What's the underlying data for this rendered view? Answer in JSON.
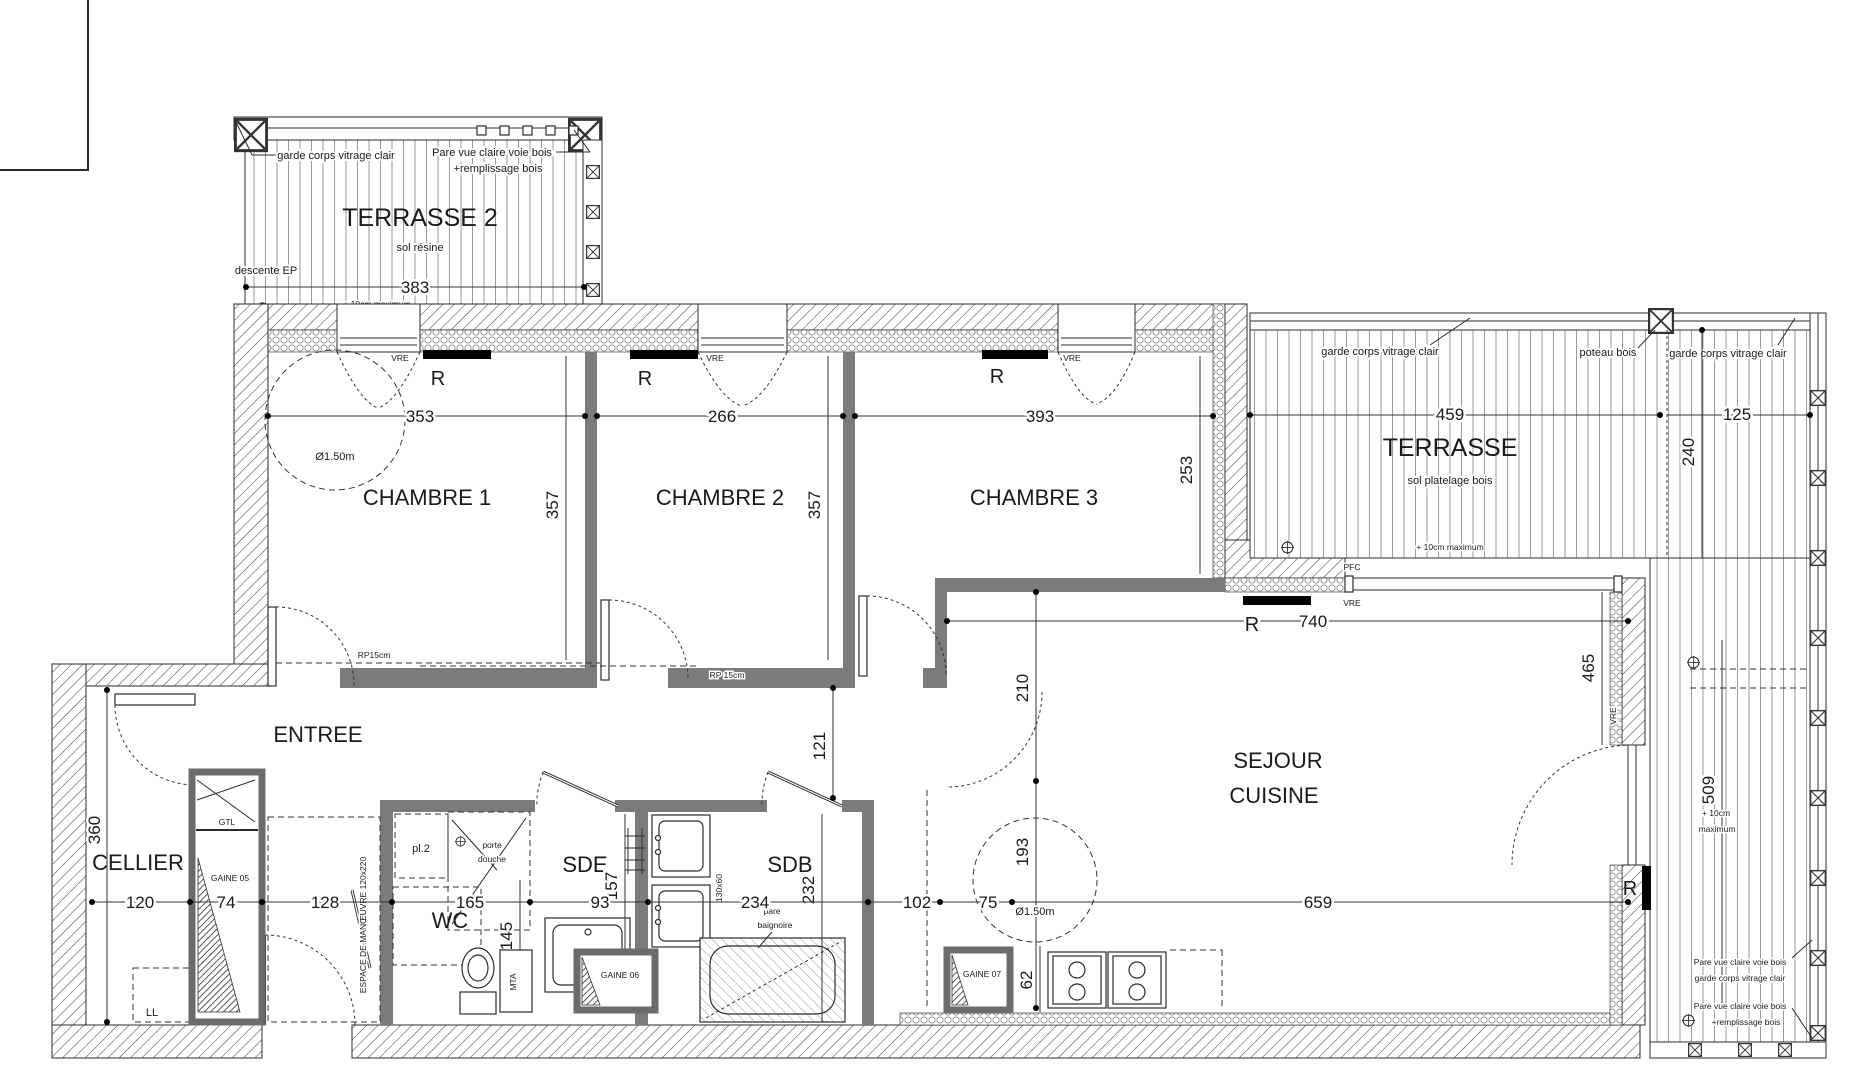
{
  "rooms": {
    "terrasse2": {
      "name": "TERRASSE 2",
      "floor": "sol résine",
      "width": "383"
    },
    "chambre1": {
      "name": "CHAMBRE 1",
      "width": "353",
      "depth": "357",
      "circle": "Ø1.50m"
    },
    "chambre2": {
      "name": "CHAMBRE 2",
      "width": "266",
      "depth": "357"
    },
    "chambre3": {
      "name": "CHAMBRE 3",
      "width": "393",
      "depth": "253"
    },
    "terrasse": {
      "name": "TERRASSE",
      "floor": "sol platelage bois",
      "width": "459",
      "side_width": "125",
      "side_depth": "240",
      "strip_depth": "509"
    },
    "sejour": {
      "name1": "SEJOUR",
      "name2": "CUISINE",
      "bay": "740",
      "h1": "210",
      "h2": "193",
      "w": "659",
      "door": "465",
      "circle": "Ø1.50m",
      "gaine_h": "62"
    },
    "entree": {
      "name": "ENTREE",
      "corridor": "121"
    },
    "cellier": {
      "name": "CELLIER",
      "depth": "360"
    },
    "wc": {
      "name": "WC",
      "depth": "145"
    },
    "sde": {
      "name": "SDE",
      "depth": "157"
    },
    "sdb": {
      "name": "SDB",
      "depth": "232",
      "vanity": "130x60"
    }
  },
  "chain": [
    "120",
    "74",
    "128",
    "165",
    "93",
    "234",
    "102",
    "75",
    "659"
  ],
  "labels": {
    "garde_corps": "garde corps vitrage clair",
    "pare_vue": "Pare vue claire voie bois",
    "remplissage": "+remplissage bois",
    "descente_ep": "descente EP",
    "max10": "+ 10cm maximum",
    "max10a": "+ 10cm",
    "max10b": "maximum",
    "poteau_bois": "poteau bois",
    "pfc": "PFC",
    "vre": "VRE",
    "r": "R",
    "rp15": "RP15cm",
    "rp15b": "RP 15cm",
    "porte": "porte",
    "douche": "douche",
    "pare": "pare",
    "baignoire": "baignoire",
    "espace": "ESPACE DE MANŒUVRE 120x220",
    "gtl": "GTL",
    "ll": "LL",
    "pl1": "pl.1",
    "pl2": "pl.2",
    "gaine05": "GAINE 05",
    "gaine06": "GAINE 06",
    "gaine07": "GAINE 07",
    "mta": "MTA"
  }
}
